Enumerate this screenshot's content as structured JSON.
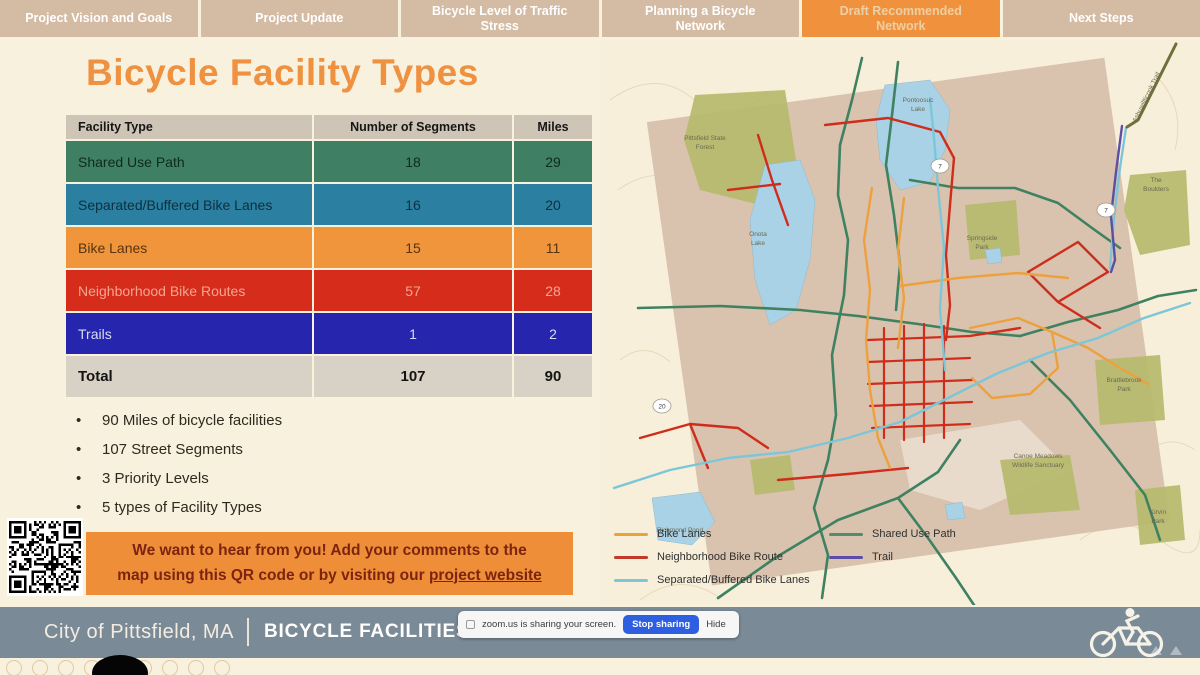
{
  "tabs": [
    {
      "label": "Project Vision and Goals",
      "active": false
    },
    {
      "label": "Project Update",
      "active": false
    },
    {
      "label": "Bicycle Level of Traffic Stress",
      "active": false
    },
    {
      "label": "Planning a Bicycle Network",
      "active": false
    },
    {
      "label": "Draft Recommended Network",
      "active": true
    },
    {
      "label": "Next Steps",
      "active": false
    }
  ],
  "title": "Bicycle Facility Types",
  "colors": {
    "active_tab_bg": "#f0923d",
    "inactive_tab_bg": "#d4bba3",
    "title_orange": "#ee9140",
    "callout_bg": "#ee8e38",
    "footer_bg": "#7b8a97",
    "slide_bg": "#f8f1dd"
  },
  "table": {
    "header_bg": "#cfc5b7",
    "header_fg": "#161616",
    "headers": [
      "Facility Type",
      "Number of Segments",
      "Miles"
    ],
    "rows": [
      {
        "label": "Shared Use Path",
        "segments": "18",
        "miles": "29",
        "bg": "#3f7f63",
        "fg": "#0f2b1e"
      },
      {
        "label": "Separated/Buffered Bike Lanes",
        "segments": "16",
        "miles": "20",
        "bg": "#2b80a1",
        "fg": "#0d2f3e"
      },
      {
        "label": "Bike Lanes",
        "segments": "15",
        "miles": "11",
        "bg": "#f0953c",
        "fg": "#59330d"
      },
      {
        "label": "Neighborhood Bike Routes",
        "segments": "57",
        "miles": "28",
        "bg": "#d52c1b",
        "fg": "#f5a58f"
      },
      {
        "label": "Trails",
        "segments": "1",
        "miles": "2",
        "bg": "#2525ae",
        "fg": "#d9dcf2"
      }
    ],
    "total": {
      "label": "Total",
      "segments": "107",
      "miles": "90",
      "bg": "#d8d1c5",
      "fg": "#141414"
    }
  },
  "bullets": [
    "90 Miles of bicycle facilities",
    "107 Street Segments",
    "3 Priority Levels",
    "5 types of Facility Types"
  ],
  "callout": {
    "line1": "We want to hear from you! Add your comments to the",
    "line2_prefix": "map using this QR code or by visiting our ",
    "link_text": "project website"
  },
  "legend": {
    "items": [
      {
        "label": "Bike Lanes",
        "color": "#e8a43c"
      },
      {
        "label": "Neighborhood Bike Route",
        "color": "#c23b28"
      },
      {
        "label": "Separated/Buffered Bike Lanes",
        "color": "#7cc6d8"
      },
      {
        "label": "Shared Use Path",
        "color": "#4e8e6e"
      },
      {
        "label": "Trail",
        "color": "#5b4fa5"
      }
    ]
  },
  "footer": {
    "city": "City of Pittsfield, MA",
    "deck_title": "BICYCLE FACILITIES M"
  },
  "banner": {
    "message": "zoom.us is sharing your screen.",
    "stop_label": "Stop sharing",
    "hide_label": "Hide",
    "button_color": "#2d5fe0"
  },
  "map": {
    "bg": "#f7efda",
    "square": {
      "x": 78,
      "y": 48,
      "w": 462,
      "h": 468,
      "rotate": -8,
      "cx": 306,
      "cy": 288,
      "fill": "#d9c3ae"
    },
    "contours": [
      "M10,60 Q55,28 92,58 T168,52",
      "M18,150 Q60,120 105,150 T190,140",
      "M540,420 Q565,390 595,410",
      "M480,500 Q520,470 560,500 T600,490",
      "M40,560 Q80,530 120,558",
      "M560,40 Q585,70 575,110",
      "M20,320 Q45,300 70,322"
    ],
    "downtown": {
      "points": "300,400 420,380 470,430 380,470 310,450",
      "fill": "#efe6d8"
    },
    "parks": [
      {
        "name": "pittsfield-state-forest",
        "points": "95,55 185,50 196,120 160,165 100,150 84,100"
      },
      {
        "name": "the-boulders",
        "points": "530,135 586,130 590,205 540,215 524,170"
      },
      {
        "name": "springside-park",
        "points": "365,165 416,160 420,215 370,220"
      },
      {
        "name": "brattlebrook-park",
        "points": "495,320 560,315 565,380 500,385"
      },
      {
        "name": "canoe-meadows",
        "points": "400,420 470,415 480,470 410,475"
      },
      {
        "name": "kirvin-park",
        "points": "535,450 580,445 585,500 540,505"
      },
      {
        "name": "small-park-sw",
        "points": "150,420 190,415 195,450 155,455"
      }
    ],
    "lakes": [
      {
        "name": "pontoosuc-lake",
        "points": "285,45 330,40 350,70 345,110 330,142 300,150 280,120 276,80"
      },
      {
        "name": "onota-lake",
        "points": "165,125 200,120 215,160 210,220 196,270 170,285 155,240 150,180"
      },
      {
        "name": "richmond-pond",
        "points": "52,458 100,452 115,482 92,505 58,500"
      },
      {
        "name": "pond-small-1",
        "points": "385,210 400,208 402,222 388,224"
      },
      {
        "name": "pond-small-2",
        "points": "345,465 362,462 365,478 348,480"
      }
    ],
    "routes": [
      {
        "type": "shared-use-path",
        "color": "#3f8160",
        "width": 2.6,
        "points": "262,18 252,60 240,105 238,155 248,200 244,255 232,315 236,375 228,420 214,468 228,515 222,558"
      },
      {
        "type": "shared-use-path",
        "color": "#3f8160",
        "width": 2.6,
        "points": "298,22 292,75 286,125 294,175 300,225 296,270"
      },
      {
        "type": "shared-use-path",
        "color": "#3f8160",
        "width": 2.6,
        "points": "38,268 120,266 200,270 258,276 318,284 372,292 420,296"
      },
      {
        "type": "shared-use-path",
        "color": "#3f8160",
        "width": 2.6,
        "points": "420,296 468,282 518,270 558,256 596,250"
      },
      {
        "type": "shared-use-path",
        "color": "#3f8160",
        "width": 2.6,
        "points": "118,558 175,518 238,480 298,458 338,432 360,400"
      },
      {
        "type": "shared-use-path",
        "color": "#3f8160",
        "width": 2.6,
        "points": "298,458 328,498 356,538 376,568"
      },
      {
        "type": "shared-use-path",
        "color": "#3f8160",
        "width": 2.6,
        "points": "310,140 358,148 415,148 458,163 492,188 520,208"
      },
      {
        "type": "shared-use-path",
        "color": "#3f8160",
        "width": 2.6,
        "points": "430,320 470,360 510,410 545,455 560,500"
      },
      {
        "type": "neighborhood-bike-route",
        "color": "#cf2c1c",
        "width": 2.4,
        "points": "225,85 288,78 340,92 354,118"
      },
      {
        "type": "neighborhood-bike-route",
        "color": "#cf2c1c",
        "width": 2.4,
        "points": "354,118 350,165 346,215 350,265 346,300"
      },
      {
        "type": "neighborhood-bike-route",
        "color": "#cf2c1c",
        "width": 2.4,
        "points": "158,95 172,140 188,185"
      },
      {
        "type": "neighborhood-bike-route",
        "color": "#cf2c1c",
        "width": 2.4,
        "points": "128,150 180,144"
      },
      {
        "type": "neighborhood-bike-route",
        "color": "#cf2c1c",
        "width": 2.2,
        "points": "284,288 284,398"
      },
      {
        "type": "neighborhood-bike-route",
        "color": "#cf2c1c",
        "width": 2.2,
        "points": "304,286 304,400"
      },
      {
        "type": "neighborhood-bike-route",
        "color": "#cf2c1c",
        "width": 2.2,
        "points": "324,284 324,402"
      },
      {
        "type": "neighborhood-bike-route",
        "color": "#cf2c1c",
        "width": 2.2,
        "points": "344,286 344,398"
      },
      {
        "type": "neighborhood-bike-route",
        "color": "#cf2c1c",
        "width": 2.2,
        "points": "268,300 370,296"
      },
      {
        "type": "neighborhood-bike-route",
        "color": "#cf2c1c",
        "width": 2.2,
        "points": "268,322 370,318"
      },
      {
        "type": "neighborhood-bike-route",
        "color": "#cf2c1c",
        "width": 2.2,
        "points": "268,344 372,340"
      },
      {
        "type": "neighborhood-bike-route",
        "color": "#cf2c1c",
        "width": 2.2,
        "points": "270,366 372,362"
      },
      {
        "type": "neighborhood-bike-route",
        "color": "#cf2c1c",
        "width": 2.2,
        "points": "272,388 370,384"
      },
      {
        "type": "neighborhood-bike-route",
        "color": "#cf2c1c",
        "width": 2.4,
        "points": "370,296 420,288"
      },
      {
        "type": "neighborhood-bike-route",
        "color": "#cf2c1c",
        "width": 2.4,
        "points": "428,232 478,202 508,232 458,262 428,232"
      },
      {
        "type": "neighborhood-bike-route",
        "color": "#cf2c1c",
        "width": 2.4,
        "points": "458,262 500,288"
      },
      {
        "type": "neighborhood-bike-route",
        "color": "#cf2c1c",
        "width": 2.4,
        "points": "40,398 90,384 138,388 168,408"
      },
      {
        "type": "neighborhood-bike-route",
        "color": "#cf2c1c",
        "width": 2.4,
        "points": "90,384 108,428"
      },
      {
        "type": "neighborhood-bike-route",
        "color": "#cf2c1c",
        "width": 2.4,
        "points": "178,440 248,434 308,428"
      },
      {
        "type": "bike-lane",
        "color": "#eda03e",
        "width": 2.4,
        "points": "272,148 264,200 270,250 266,300 270,350 278,398 290,428"
      },
      {
        "type": "bike-lane",
        "color": "#eda03e",
        "width": 2.4,
        "points": "304,158 298,210 304,258 298,308"
      },
      {
        "type": "bike-lane",
        "color": "#eda03e",
        "width": 2.4,
        "points": "370,288 418,278 452,292 458,328 430,354 392,358 372,338"
      },
      {
        "type": "bike-lane",
        "color": "#eda03e",
        "width": 2.4,
        "points": "452,292 488,308 520,328 548,344"
      },
      {
        "type": "bike-lane",
        "color": "#eda03e",
        "width": 2.4,
        "points": "300,246 358,238 418,233 468,238"
      },
      {
        "type": "separated-buffered",
        "color": "#7cc6d8",
        "width": 2.4,
        "points": "14,448 70,430 128,418 188,412 248,398 300,382 348,358 398,333 448,313 498,298 544,278 590,263"
      },
      {
        "type": "separated-buffered",
        "color": "#7cc6d8",
        "width": 2.4,
        "points": "345,330 340,268 344,208 338,148 334,98 330,58"
      },
      {
        "type": "separated-buffered",
        "color": "#7cc6d8",
        "width": 2.4,
        "points": "510,228 514,178 520,128 526,88"
      },
      {
        "type": "trail",
        "color": "#5b4fa5",
        "width": 2.4,
        "points": "522,86 516,132 511,176 515,220 511,232"
      },
      {
        "type": "regional-trail",
        "color": "#6f6f3c",
        "width": 3,
        "points": "576,4 556,44 538,80 527,87"
      }
    ],
    "shields": [
      {
        "x": 340,
        "y": 126,
        "label": "7"
      },
      {
        "x": 506,
        "y": 170,
        "label": "7"
      },
      {
        "x": 62,
        "y": 366,
        "label": "20"
      }
    ],
    "labels": [
      {
        "x": 105,
        "y": 100,
        "text": "Pittsfield State"
      },
      {
        "x": 105,
        "y": 109,
        "text": "Forest"
      },
      {
        "x": 318,
        "y": 62,
        "text": "Pontoosuc"
      },
      {
        "x": 318,
        "y": 71,
        "text": "Lake"
      },
      {
        "x": 158,
        "y": 196,
        "text": "Onota"
      },
      {
        "x": 158,
        "y": 205,
        "text": "Lake"
      },
      {
        "x": 382,
        "y": 200,
        "text": "Springside"
      },
      {
        "x": 382,
        "y": 209,
        "text": "Park"
      },
      {
        "x": 556,
        "y": 142,
        "text": "The"
      },
      {
        "x": 556,
        "y": 151,
        "text": "Boulders"
      },
      {
        "x": 524,
        "y": 342,
        "text": "Brattlebrook"
      },
      {
        "x": 524,
        "y": 351,
        "text": "Park"
      },
      {
        "x": 438,
        "y": 418,
        "text": "Canoe Meadows"
      },
      {
        "x": 438,
        "y": 427,
        "text": "Wildlife Sanctuary"
      },
      {
        "x": 80,
        "y": 492,
        "text": "Richmond Pond"
      },
      {
        "x": 558,
        "y": 474,
        "text": "Kirvin"
      },
      {
        "x": 558,
        "y": 483,
        "text": "Park"
      },
      {
        "x": 548,
        "y": 58,
        "text": "Ashuwillticook Trail",
        "rotate": -64
      }
    ]
  }
}
